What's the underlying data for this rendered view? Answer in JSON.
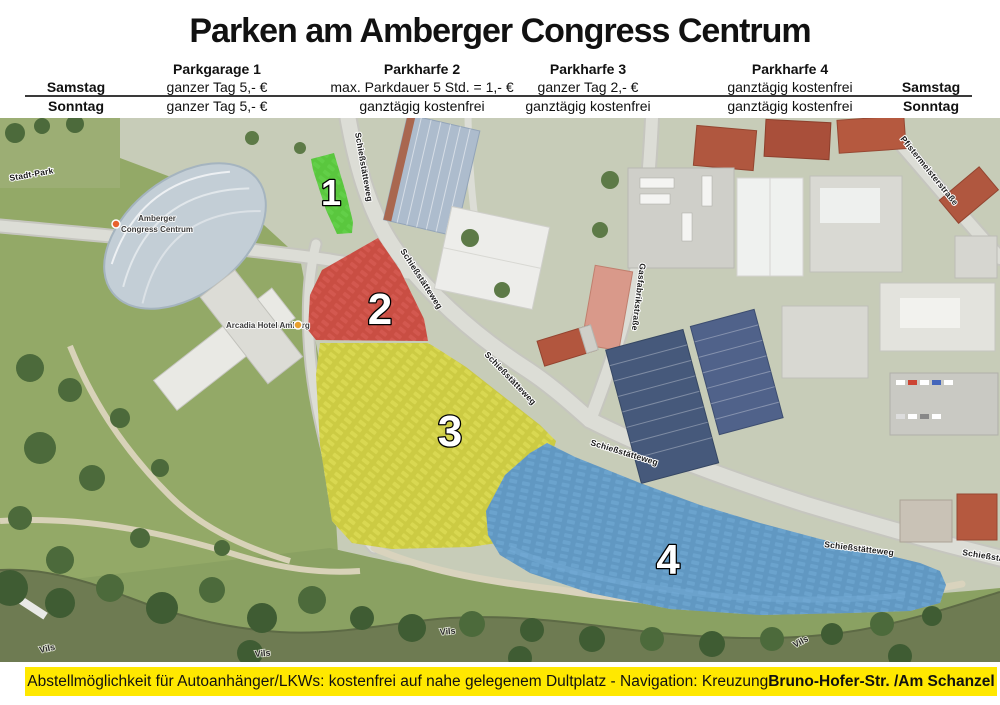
{
  "title": "Parken am Amberger Congress Centrum",
  "pricing_table": {
    "columns": [
      "Parkgarage 1",
      "Parkharfe 2",
      "Parkharfe 3",
      "Parkharfe 4"
    ],
    "rows": [
      {
        "day": "Samstag",
        "cells": [
          "ganzer Tag 5,- €",
          "max. Parkdauer 5 Std.  = 1,- €",
          "ganzer Tag 2,- €",
          "ganztägig kostenfrei"
        ]
      },
      {
        "day": "Sonntag",
        "cells": [
          "ganzer Tag 5,- €",
          "ganztägig kostenfrei",
          "ganztägig kostenfrei",
          "ganztägig kostenfrei"
        ]
      }
    ]
  },
  "map": {
    "zones": [
      {
        "number": "1",
        "color": "#3fcb1d"
      },
      {
        "number": "2",
        "color": "#cf2418"
      },
      {
        "number": "3",
        "color": "#d6d409"
      },
      {
        "number": "4",
        "color": "#2f86c8"
      }
    ],
    "streets": {
      "schiessstaetteweg": "Schießstätteweg",
      "gasfabrikstrasse": "Gasfabrikstraße",
      "pfistermeisterstrasse": "Pfistermeisterstraße"
    },
    "park_label": "Stadt-Park",
    "river_label": "Vils",
    "pois": [
      {
        "line1": "Amberger",
        "line2": "Congress Centrum"
      },
      {
        "line1": "Arcadia Hotel Amberg"
      }
    ]
  },
  "footer": {
    "text": "Abstellmöglichkeit für Autoanhänger/LKWs: kostenfrei auf nahe gelegenem Dultplatz - Navigation:  Kreuzung ",
    "text_bold": "Bruno-Hofer-Str. /Am Schanzel",
    "background": "#ffe800"
  }
}
